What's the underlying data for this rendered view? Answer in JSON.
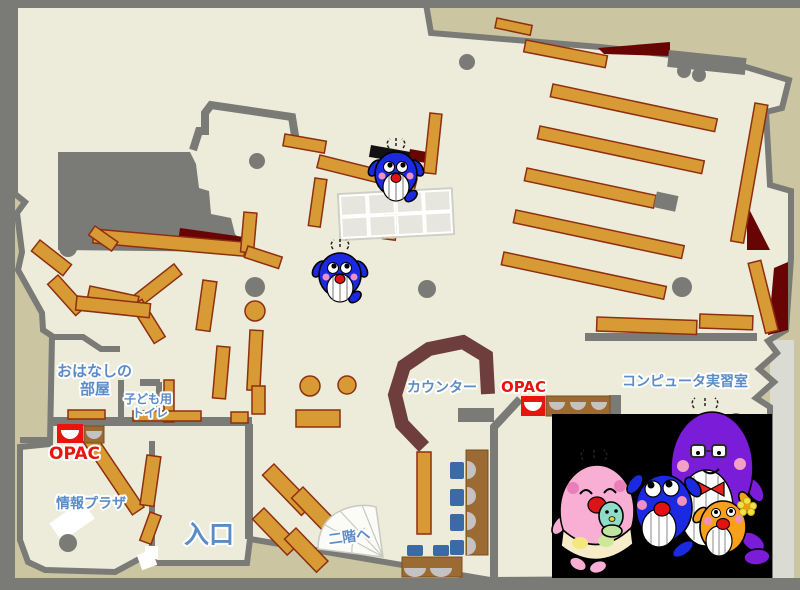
{
  "map": {
    "type": "library-floor-map",
    "labels": {
      "ohanashi_line1": "おはなしの",
      "ohanashi_line2": "部屋",
      "toilet_line1": "子ども用",
      "toilet_line2": "トイレ",
      "opac_left": "OPAC",
      "opac_right": "OPAC",
      "joho_plaza": "情報プラザ",
      "entrance": "入口",
      "counter": "カウンター",
      "computer_room": "コンピュータ実習室",
      "stairs_to_2f": "二階へ"
    },
    "colors": {
      "outside": "#cbc5a1",
      "frame_wall": "#7a7a76",
      "floor": "#edecdb",
      "shelf": "#d89a35",
      "shelf_border": "#8d2f10",
      "desk_brown": "#9c6b33",
      "counter_maroon": "#6e3e3e",
      "dark_red": "#690404",
      "opac_red": "#e8150f",
      "label_blue": "#5b8cc8",
      "chair_blue": "#3a6ba6",
      "whale_blue": "#1b2ae0",
      "whale_pink": "#f9aed4",
      "whale_purple": "#7a1cd8",
      "whale_orange": "#f6a01c",
      "baby_teal": "#8fdcc8",
      "photo_background": "#000000"
    },
    "icons": {
      "map_mascots": "whale-mascot",
      "corner_illustration": "whale-family-illustration"
    }
  }
}
